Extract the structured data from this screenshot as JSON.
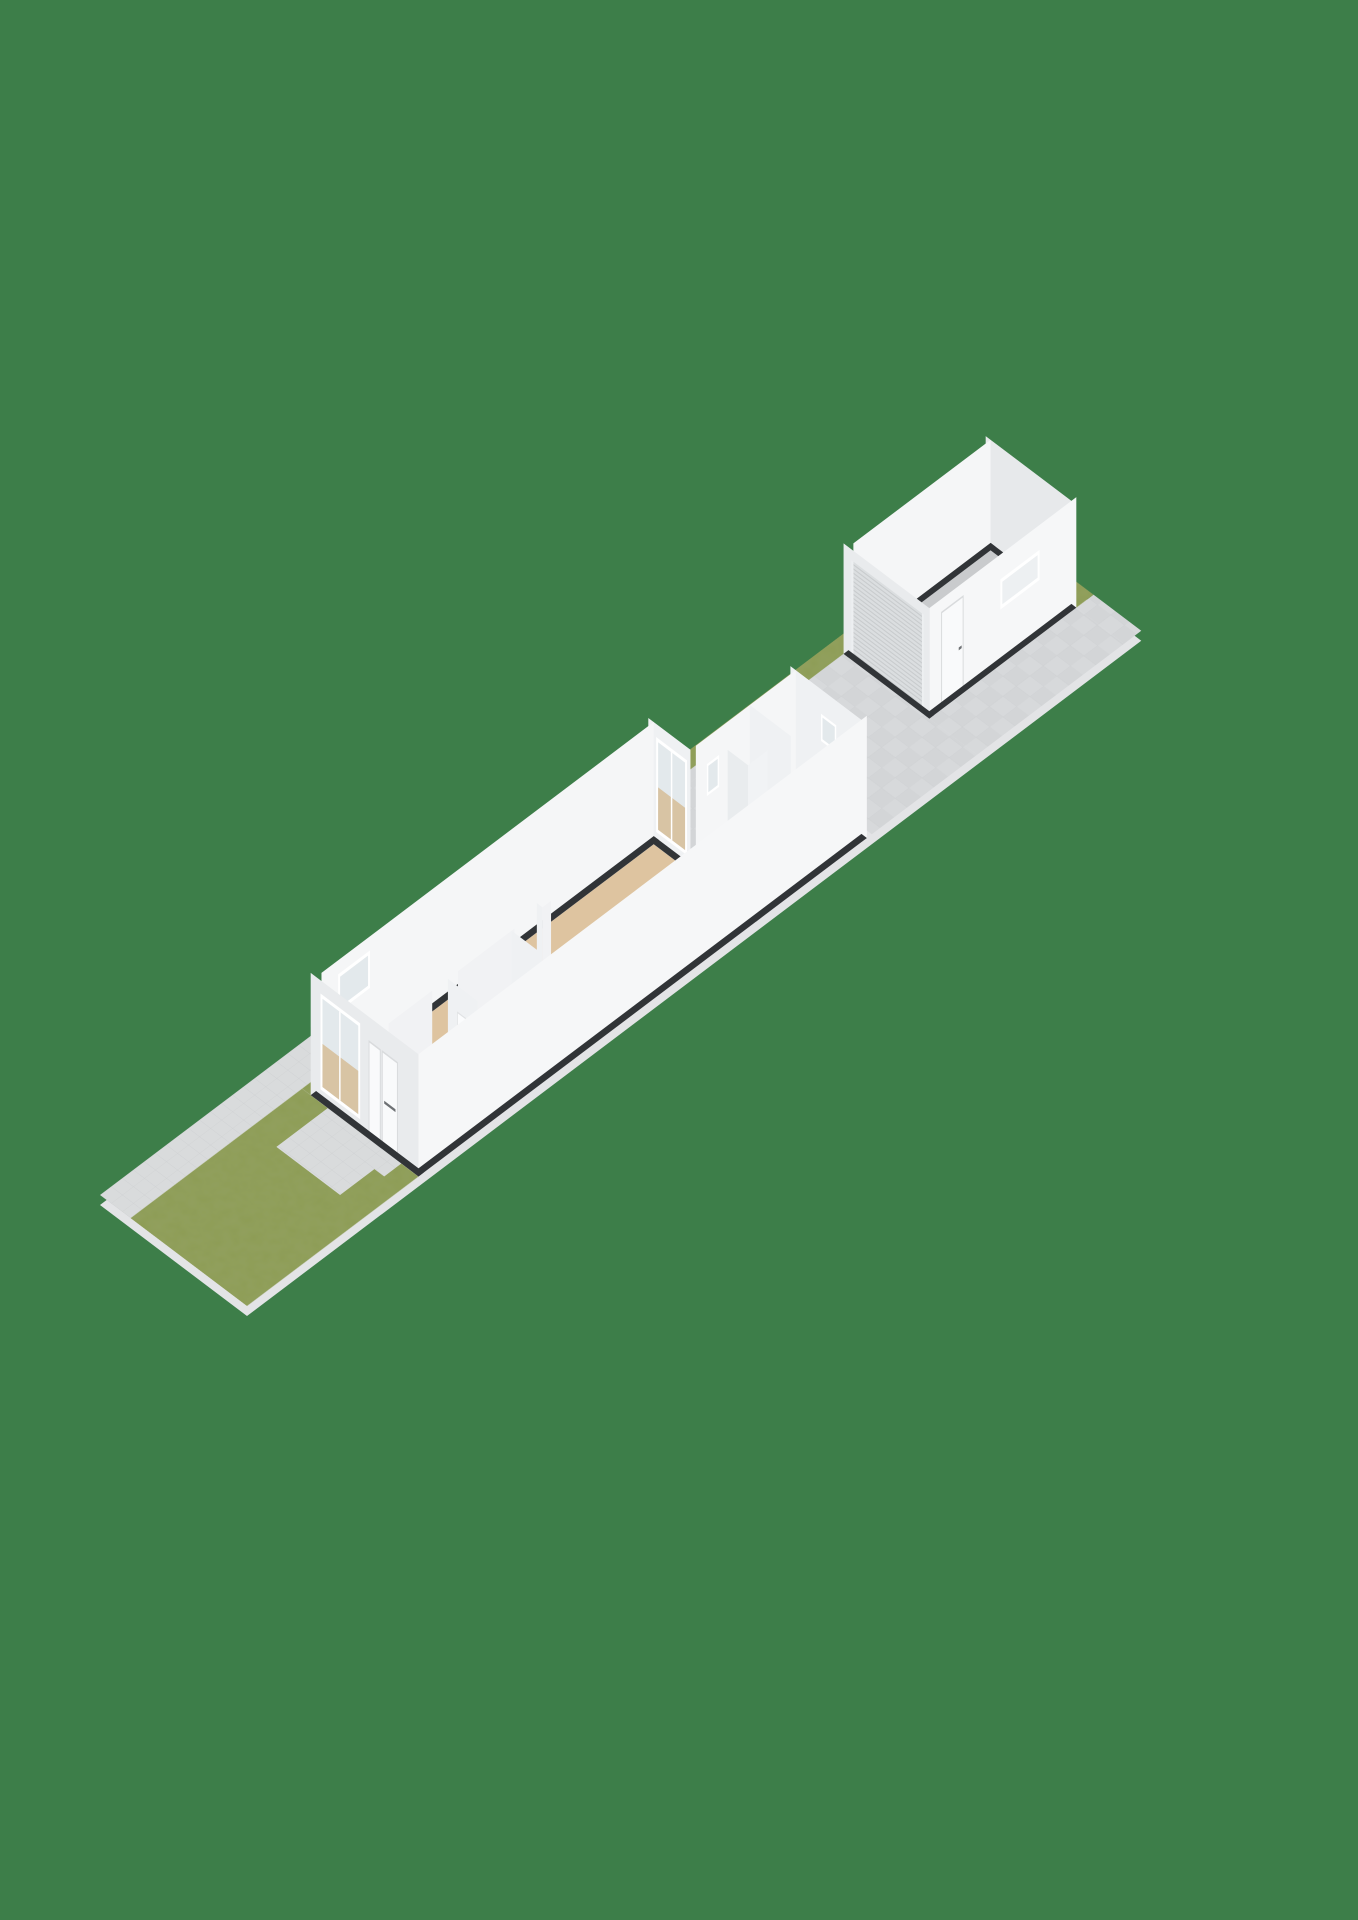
{
  "meta": {
    "app": "3d-floorplan-viewer",
    "view": "site-plan-perspective",
    "image_size": "1358x1920"
  },
  "scene": {
    "background_color": "#3D7E49",
    "projection": {
      "iso": [
        24.5,
        -18.5,
        24.5,
        18.5,
        100,
        1195
      ],
      "z_scale": 47,
      "shadow_offset": 10
    },
    "colors": {
      "bg": "#3D7E49",
      "slab_edge": "#E3E4E6",
      "grass": "#8D9C55",
      "paving": "#D9DBDC",
      "paving_line": "#CBCDCF",
      "terrace": "#D3D5D7",
      "terrace_alt": "#D7D9DB",
      "terrace_line": "#CDCFD1",
      "wall_top": "#313437",
      "wall_ext_bright": "#F6F7F8",
      "wall_ext_dim": "#E9EBED",
      "wall_in_bright": "#F5F6F7",
      "wall_in_mid": "#EFF1F3",
      "wall_in_mid2": "#F1F2F4",
      "wall_in_dark": "#E7E9EB",
      "floor_beige": "#DEC4A0",
      "floor_wood": "#C69A66",
      "floor_blue": "#CBD8E0",
      "floor_garage": "#C9CBCD",
      "glass": "#E3E9EC",
      "door_white": "#F9FAFB",
      "roller_base": "#DBDEE0",
      "roller_rib": "#C9CCCE",
      "handle_dark": "#6E7174"
    },
    "areas": [
      {
        "name": "lot",
        "type": "site-strip",
        "note": "long diagonal parcel"
      },
      {
        "name": "front-garden",
        "type": "grass"
      },
      {
        "name": "front-path",
        "type": "paving"
      },
      {
        "name": "nw-sidewalk",
        "type": "paving"
      },
      {
        "name": "terrace",
        "type": "paving-tiles"
      },
      {
        "name": "house",
        "rooms": [
          "living-room",
          "hall",
          "toilet",
          "bathroom",
          "storage-room"
        ]
      },
      {
        "name": "garage",
        "features": [
          "roller-door",
          "side-door",
          "window"
        ]
      }
    ],
    "items": [
      {
        "k": "rect",
        "g": "screen",
        "x": 0,
        "y": 0,
        "w": 1358,
        "h": 1920,
        "fill": "bg",
        "name": "background"
      },
      {
        "k": "rect",
        "g": "isoS",
        "x": 0,
        "y": 0,
        "w": 36.5,
        "h": 6,
        "fill": "slab_edge",
        "name": "ground-slab-edge"
      },
      {
        "k": "rect",
        "g": "iso",
        "x": 0,
        "y": 0,
        "w": 21,
        "h": 1.25,
        "fill": "url(#pav)",
        "name": "sidewalk-nw"
      },
      {
        "k": "rect",
        "g": "iso",
        "x": 0,
        "y": 1.25,
        "w": 7,
        "h": 4.75,
        "fill": "grass",
        "f": "grass",
        "name": "front-garden-grass"
      },
      {
        "k": "rect",
        "g": "iso",
        "x": 4.9,
        "y": 2.3,
        "w": 2.1,
        "h": 2.6,
        "fill": "url(#pav)",
        "name": "front-path"
      },
      {
        "k": "rect",
        "g": "iso",
        "x": 6.3,
        "y": 3.85,
        "w": 0.72,
        "h": 1.45,
        "fill": "url(#pav)",
        "name": "door-step"
      },
      {
        "k": "rect",
        "g": "iso",
        "x": 7,
        "y": 1.25,
        "w": 14,
        "h": 0.35,
        "fill": "grass",
        "f": "grass",
        "name": "side-grass-strip"
      },
      {
        "k": "rect",
        "g": "iso",
        "x": 21,
        "y": 0,
        "w": 15.5,
        "h": 0.55,
        "fill": "grass",
        "f": "grass",
        "name": "back-grass-strip-nw"
      },
      {
        "k": "rect",
        "g": "iso",
        "x": 21,
        "y": 0.55,
        "w": 4.5,
        "h": 0.35,
        "fill": "url(#ter)",
        "name": "terrace-tiles"
      },
      {
        "k": "rect",
        "g": "iso",
        "x": 21,
        "y": 0.9,
        "w": 4.5,
        "h": 2.2,
        "fill": "url(#ter)",
        "name": "terrace-tiles"
      },
      {
        "k": "rect",
        "g": "iso",
        "x": 25.5,
        "y": 0.55,
        "w": 4.3,
        "h": 5.45,
        "fill": "url(#ter)",
        "name": "terrace-tiles"
      },
      {
        "k": "rect",
        "g": "iso",
        "x": 29.8,
        "y": 4.05,
        "w": 6,
        "h": 1.95,
        "fill": "url(#ter)",
        "name": "terrace-tiles"
      },
      {
        "k": "rect",
        "g": "iso",
        "x": 35.8,
        "y": 4.05,
        "w": 0.7,
        "h": 1.95,
        "fill": "url(#ter)",
        "name": "terrace-tiles"
      },
      {
        "k": "rect",
        "g": "iso",
        "x": 35.8,
        "y": 0,
        "w": 0.7,
        "h": 4.05,
        "fill": "grass",
        "f": "grass",
        "name": "garage-back-grass"
      },
      {
        "k": "rect",
        "g": "iso",
        "x": 30.0,
        "y": 0.75,
        "w": 5.6,
        "h": 3.1,
        "fill": "floor_garage",
        "name": "garage-floor"
      },
      {
        "k": "rect",
        "g": "fu:35.6",
        "x": 0.55,
        "y": 0,
        "w": 3.5,
        "h": 2.35,
        "fill": "wall_in_dark",
        "name": "garage-ne-wall-face"
      },
      {
        "k": "rect",
        "g": "iso",
        "x": 35.6,
        "y": 0.55,
        "w": 0.2,
        "h": 3.5,
        "fill": "wall_top",
        "name": "garage-ne-wall-top"
      },
      {
        "k": "rect",
        "g": "fv:0.75",
        "x": 30.0,
        "y": 0,
        "w": 5.6,
        "h": 2.35,
        "fill": "wall_in_bright",
        "name": "garage-nw-wall-face"
      },
      {
        "k": "rect",
        "g": "iso",
        "x": 29.8,
        "y": 0.55,
        "w": 6.0,
        "h": 0.2,
        "fill": "wall_top",
        "name": "garage-nw-wall-top"
      },
      {
        "k": "rect",
        "g": "fv:4.05",
        "x": 29.8,
        "y": 0,
        "w": 6,
        "h": 2.35,
        "fill": "wall_ext_bright",
        "name": "garage-se-wall-face"
      },
      {
        "k": "rect",
        "g": "fv:4.05",
        "x": 30.3,
        "y": 0,
        "w": 0.88,
        "h": 2.06,
        "fill": "door_white",
        "stroke": "#D9DBDD",
        "sw": 0.04,
        "name": "garage-side-door"
      },
      {
        "k": "rect",
        "g": "fv:4.05",
        "x": 31.0,
        "y": 0.98,
        "w": 0.12,
        "h": 0.06,
        "fill": "handle_dark",
        "name": "garage-door-handle"
      },
      {
        "k": "rect",
        "g": "fv:4.05",
        "x": 32.7,
        "y": 1.18,
        "w": 1.6,
        "h": 0.64,
        "fill": "#FFFFFF",
        "name": "garage-window-frame"
      },
      {
        "k": "rect",
        "g": "fv:4.05",
        "x": 32.78,
        "y": 1.26,
        "w": 1.44,
        "h": 0.48,
        "fill": "#EDF0F2",
        "name": "garage-window-glass"
      },
      {
        "k": "rect",
        "g": "iso",
        "x": 29.8,
        "y": 3.85,
        "w": 6.0,
        "h": 0.2,
        "fill": "wall_top",
        "name": "garage-se-wall-top"
      },
      {
        "k": "rect",
        "g": "fu:29.8",
        "x": 0.55,
        "y": 0,
        "w": 3.5,
        "h": 2.35,
        "fill": "wall_ext_dim",
        "name": "garage-sw-wall-face"
      },
      {
        "k": "rect",
        "g": "fu:29.8",
        "x": 0.95,
        "y": 0,
        "w": 2.8,
        "h": 2.12,
        "fill": "url(#ribs)",
        "name": "garage-roller-door"
      },
      {
        "k": "rect",
        "g": "fu:29.8",
        "x": 0.87,
        "y": 0,
        "w": 0.08,
        "h": 2.12,
        "fill": "#EDEFF1",
        "name": "roller-rail-left"
      },
      {
        "k": "rect",
        "g": "fu:29.8",
        "x": 3.75,
        "y": 0,
        "w": 0.08,
        "h": 2.12,
        "fill": "#EDEFF1",
        "name": "roller-rail-right"
      },
      {
        "k": "rect",
        "g": "iso",
        "x": 29.8,
        "y": 0.55,
        "w": 0.2,
        "h": 3.5,
        "fill": "wall_top",
        "name": "garage-sw-wall-top"
      },
      {
        "k": "rect",
        "g": "iso",
        "x": 7.22,
        "y": 1.82,
        "w": 13.56,
        "h": 3.96,
        "fill": "floor_beige",
        "name": "living-room-floor"
      },
      {
        "k": "rect",
        "g": "iso",
        "x": 9.76,
        "y": 4.62,
        "w": 2.48,
        "h": 1.16,
        "fill": "floor_wood",
        "name": "toilet-floor"
      },
      {
        "k": "rect",
        "g": "iso",
        "x": 21,
        "y": 3.32,
        "w": 2.2,
        "h": 2.46,
        "fill": "floor_blue",
        "name": "bathroom-floor"
      },
      {
        "k": "rect",
        "g": "iso",
        "x": 23.32,
        "y": 3.32,
        "w": 1.76,
        "h": 2.46,
        "fill": "floor_beige",
        "name": "storage-room-floor"
      },
      {
        "k": "rect",
        "g": "iso",
        "x": 20.74,
        "y": 3.32,
        "w": 0.3,
        "h": 0.88,
        "fill": "wall_top",
        "name": "doorway-threshold-frame"
      },
      {
        "k": "rect",
        "g": "iso",
        "x": 20.8,
        "y": 3.4,
        "w": 0.18,
        "h": 0.72,
        "fill": "floor_blue",
        "name": "doorway-threshold-inner"
      },
      {
        "k": "rect",
        "g": "fu:20.78",
        "x": 1.6,
        "y": 0,
        "w": 1.72,
        "h": 2.6,
        "fill": "wall_in_mid",
        "name": "living-ne-wall-face"
      },
      {
        "k": "rect",
        "g": "fu:20.78",
        "x": 1.92,
        "y": 0.3,
        "w": 1.26,
        "h": 2.02,
        "fill": "#FFFFFF",
        "name": "terrace-window-frame"
      },
      {
        "k": "rect",
        "g": "fu:20.78",
        "x": 2.0,
        "y": 0.38,
        "w": 1.1,
        "h": 1.86,
        "fill": "glass",
        "name": "terrace-window-glass"
      },
      {
        "k": "rect",
        "g": "fu:20.78",
        "x": 2.0,
        "y": 0.38,
        "w": 1.1,
        "h": 0.9,
        "fill": "#D8C4A4",
        "name": "terrace-window-lower"
      },
      {
        "k": "rect",
        "g": "fu:20.78",
        "x": 2.52,
        "y": 0.38,
        "w": 0.06,
        "h": 1.86,
        "fill": "#FFFFFF",
        "name": "terrace-window-mullion"
      },
      {
        "k": "rect",
        "g": "iso",
        "x": 20.78,
        "y": 1.6,
        "w": 0.22,
        "h": 1.72,
        "fill": "wall_top",
        "name": "living-ne-wall-top"
      },
      {
        "k": "rect",
        "g": "fu:20.78",
        "x": 4.2,
        "y": 0,
        "w": 1.8,
        "h": 2.6,
        "fill": "wall_in_mid",
        "name": "hall-ne-wall-face"
      },
      {
        "k": "rect",
        "g": "iso",
        "x": 20.78,
        "y": 4.2,
        "w": 0.22,
        "h": 1.8,
        "fill": "wall_top",
        "name": "hall-ne-wall-top"
      },
      {
        "k": "rect",
        "g": "fu:25.08",
        "x": 3.1,
        "y": 0,
        "w": 2.9,
        "h": 2.6,
        "fill": "wall_in_mid",
        "name": "storage-ne-wall-face"
      },
      {
        "k": "rect",
        "g": "fu:25.08",
        "x": 4.35,
        "y": 1.5,
        "w": 0.62,
        "h": 0.58,
        "fill": "#FFFFFF",
        "name": "storage-window-frame"
      },
      {
        "k": "rect",
        "g": "fu:25.08",
        "x": 4.41,
        "y": 1.56,
        "w": 0.5,
        "h": 0.46,
        "fill": "glass",
        "name": "storage-window-glass"
      },
      {
        "k": "rect",
        "g": "iso",
        "x": 25.08,
        "y": 3.1,
        "w": 0.22,
        "h": 2.9,
        "fill": "wall_top",
        "name": "storage-ne-wall-top"
      },
      {
        "k": "rect",
        "g": "fv:3.32",
        "x": 21.0,
        "y": 0,
        "w": 4.08,
        "h": 2.6,
        "fill": "wall_in_bright",
        "name": "extension-nw-wall-face"
      },
      {
        "k": "rect",
        "g": "fv:3.32",
        "x": 21.45,
        "y": 1.35,
        "w": 0.5,
        "h": 0.68,
        "fill": "#FFFFFF",
        "name": "bathroom-window-frame"
      },
      {
        "k": "rect",
        "g": "fv:3.32",
        "x": 21.51,
        "y": 1.41,
        "w": 0.38,
        "h": 0.56,
        "fill": "glass",
        "name": "bathroom-window-glass"
      },
      {
        "k": "rect",
        "g": "iso",
        "x": 21.0,
        "y": 3.1,
        "w": 4.3,
        "h": 0.22,
        "fill": "wall_top",
        "name": "extension-nw-wall-top"
      },
      {
        "k": "rect",
        "g": "fu:23.2",
        "x": 3.32,
        "y": 0,
        "w": 1.68,
        "h": 2.6,
        "fill": "wall_in_mid",
        "name": "extension-partition-face"
      },
      {
        "k": "rect",
        "g": "iso",
        "x": 23.2,
        "y": 3.32,
        "w": 0.12,
        "h": 1.68,
        "fill": "wall_top",
        "name": "extension-partition-top"
      },
      {
        "k": "rect",
        "g": "iso",
        "x": 22.3,
        "y": 3.32,
        "w": 0.8,
        "h": 0.83,
        "fill": "#F3F5F6",
        "name": "shower-cabinet-top"
      },
      {
        "k": "rect",
        "g": "fu:22.3",
        "x": 3.32,
        "y": 0,
        "w": 0.83,
        "h": 2.0,
        "fill": "#E9ECEE",
        "name": "shower-cabinet-sw-face"
      },
      {
        "k": "rect",
        "g": "fv:4.15",
        "x": 22.3,
        "y": 0,
        "w": 0.8,
        "h": 2.0,
        "fill": "#F1F3F5",
        "name": "shower-cabinet-se-face"
      },
      {
        "k": "rect",
        "g": "fv:1.82",
        "x": 7.22,
        "y": 0,
        "w": 13.56,
        "h": 2.6,
        "fill": "wall_in_bright",
        "name": "living-nw-wall-face"
      },
      {
        "k": "rect",
        "g": "fv:1.82",
        "x": 7.9,
        "y": 1.5,
        "w": 1.3,
        "h": 0.8,
        "fill": "#FFFFFF",
        "name": "nw-window-frame"
      },
      {
        "k": "rect",
        "g": "fv:1.82",
        "x": 7.98,
        "y": 1.58,
        "w": 1.14,
        "h": 0.64,
        "fill": "glass",
        "name": "nw-window-glass"
      },
      {
        "k": "rect",
        "g": "iso",
        "x": 7.0,
        "y": 1.6,
        "w": 14.0,
        "h": 0.22,
        "fill": "wall_top",
        "name": "nw-wall-top"
      },
      {
        "k": "rect",
        "g": "fv:4.56",
        "x": 7.22,
        "y": 0,
        "w": 1.78,
        "h": 2.6,
        "fill": "wall_in_mid2",
        "name": "partition-living-hall-a"
      },
      {
        "k": "rect",
        "g": "iso",
        "x": 7.22,
        "y": 4.44,
        "w": 1.78,
        "h": 0.12,
        "fill": "wall_top",
        "name": "partition-a-top"
      },
      {
        "k": "rect",
        "g": "iso",
        "x": 8.95,
        "y": 4.4,
        "w": 1.1,
        "h": 0.2,
        "fill": "wall_top",
        "name": "interior-door-lintel"
      },
      {
        "k": "rect",
        "g": "iso",
        "x": 9.03,
        "y": 4.46,
        "w": 0.94,
        "h": 0.08,
        "fill": "#F7F8F9",
        "name": "interior-door-frame"
      },
      {
        "k": "rect",
        "g": "fv:4.56",
        "x": 10.05,
        "y": 0,
        "w": 2.31,
        "h": 2.6,
        "fill": "wall_in_mid2",
        "name": "partition-living-hall-b"
      },
      {
        "k": "rect",
        "g": "iso",
        "x": 10.05,
        "y": 4.44,
        "w": 2.31,
        "h": 0.12,
        "fill": "wall_top",
        "name": "partition-b-top"
      },
      {
        "k": "rect",
        "g": "fu:13.5",
        "x": 4.33,
        "y": 0,
        "w": 0.23,
        "h": 2.6,
        "fill": "wall_in_mid",
        "name": "kitchen-stub-face-sw"
      },
      {
        "k": "rect",
        "g": "fv:4.56",
        "x": 13.5,
        "y": 0,
        "w": 0.35,
        "h": 2.6,
        "fill": "wall_in_mid2",
        "name": "kitchen-stub-face-se"
      },
      {
        "k": "rect",
        "g": "iso",
        "x": 13.5,
        "y": 4.33,
        "w": 0.35,
        "h": 0.23,
        "fill": "wall_top",
        "name": "kitchen-stub-top"
      },
      {
        "k": "rect",
        "g": "fu:9.64",
        "x": 4.56,
        "y": 0,
        "w": 1.22,
        "h": 2.6,
        "fill": "wall_in_mid",
        "name": "toilet-wall-a-face"
      },
      {
        "k": "rect",
        "g": "fu:9.64",
        "x": 4.95,
        "y": 0,
        "w": 0.75,
        "h": 2.04,
        "fill": "#FBFCFD",
        "stroke": "#E0E2E4",
        "sw": 0.03,
        "name": "toilet-door-leaf"
      },
      {
        "k": "rect",
        "g": "iso",
        "x": 9.64,
        "y": 4.56,
        "w": 0.12,
        "h": 1.22,
        "fill": "wall_top",
        "name": "toilet-wall-a-top"
      },
      {
        "k": "rect",
        "g": "fu:12.24",
        "x": 4.56,
        "y": 0,
        "w": 1.22,
        "h": 2.6,
        "fill": "wall_in_mid",
        "name": "toilet-wall-b-face"
      },
      {
        "k": "rect",
        "g": "iso",
        "x": 12.24,
        "y": 4.56,
        "w": 0.12,
        "h": 1.22,
        "fill": "wall_top",
        "name": "toilet-wall-b-top"
      },
      {
        "k": "rect",
        "g": "fv:6.0",
        "x": 7.0,
        "y": 0,
        "w": 18.3,
        "h": 2.6,
        "fill": "wall_ext_bright",
        "name": "se-facade-face"
      },
      {
        "k": "rect",
        "g": "iso",
        "x": 7.0,
        "y": 5.78,
        "w": 18.3,
        "h": 0.22,
        "fill": "wall_top",
        "name": "se-facade-top"
      },
      {
        "k": "rect",
        "g": "fu:7.0",
        "x": 1.6,
        "y": 0,
        "w": 4.4,
        "h": 2.6,
        "fill": "wall_ext_dim",
        "name": "sw-facade-face"
      },
      {
        "k": "rect",
        "g": "fu:7.0",
        "x": 2.0,
        "y": 0.28,
        "w": 1.62,
        "h": 2.04,
        "fill": "#FFFFFF",
        "name": "front-window-frame"
      },
      {
        "k": "rect",
        "g": "fu:7.0",
        "x": 2.08,
        "y": 0.36,
        "w": 1.46,
        "h": 1.88,
        "fill": "glass",
        "name": "front-window-glass"
      },
      {
        "k": "rect",
        "g": "fu:7.0",
        "x": 2.08,
        "y": 0.36,
        "w": 1.46,
        "h": 0.92,
        "fill": "#D8C4A4",
        "name": "front-window-lower"
      },
      {
        "k": "rect",
        "g": "fu:7.0",
        "x": 2.76,
        "y": 0.36,
        "w": 0.06,
        "h": 1.88,
        "fill": "#FFFFFF",
        "name": "front-window-mullion"
      },
      {
        "k": "rect",
        "g": "fu:7.0",
        "x": 3.98,
        "y": 0,
        "w": 0.46,
        "h": 2.08,
        "fill": "door_white",
        "stroke": "#D9DBDD",
        "sw": 0.04,
        "name": "utility-door"
      },
      {
        "k": "rect",
        "g": "fu:7.0",
        "x": 4.52,
        "y": 0,
        "w": 0.62,
        "h": 2.08,
        "fill": "door_white",
        "stroke": "#D9DBDD",
        "sw": 0.04,
        "name": "front-door"
      },
      {
        "k": "rect",
        "g": "fu:7.0",
        "x": 4.6,
        "y": 1.0,
        "w": 0.46,
        "h": 0.06,
        "fill": "handle_dark",
        "name": "front-door-handle"
      },
      {
        "k": "rect",
        "g": "iso",
        "x": 7.0,
        "y": 1.6,
        "w": 0.22,
        "h": 4.4,
        "fill": "wall_top",
        "name": "sw-facade-top"
      }
    ]
  }
}
